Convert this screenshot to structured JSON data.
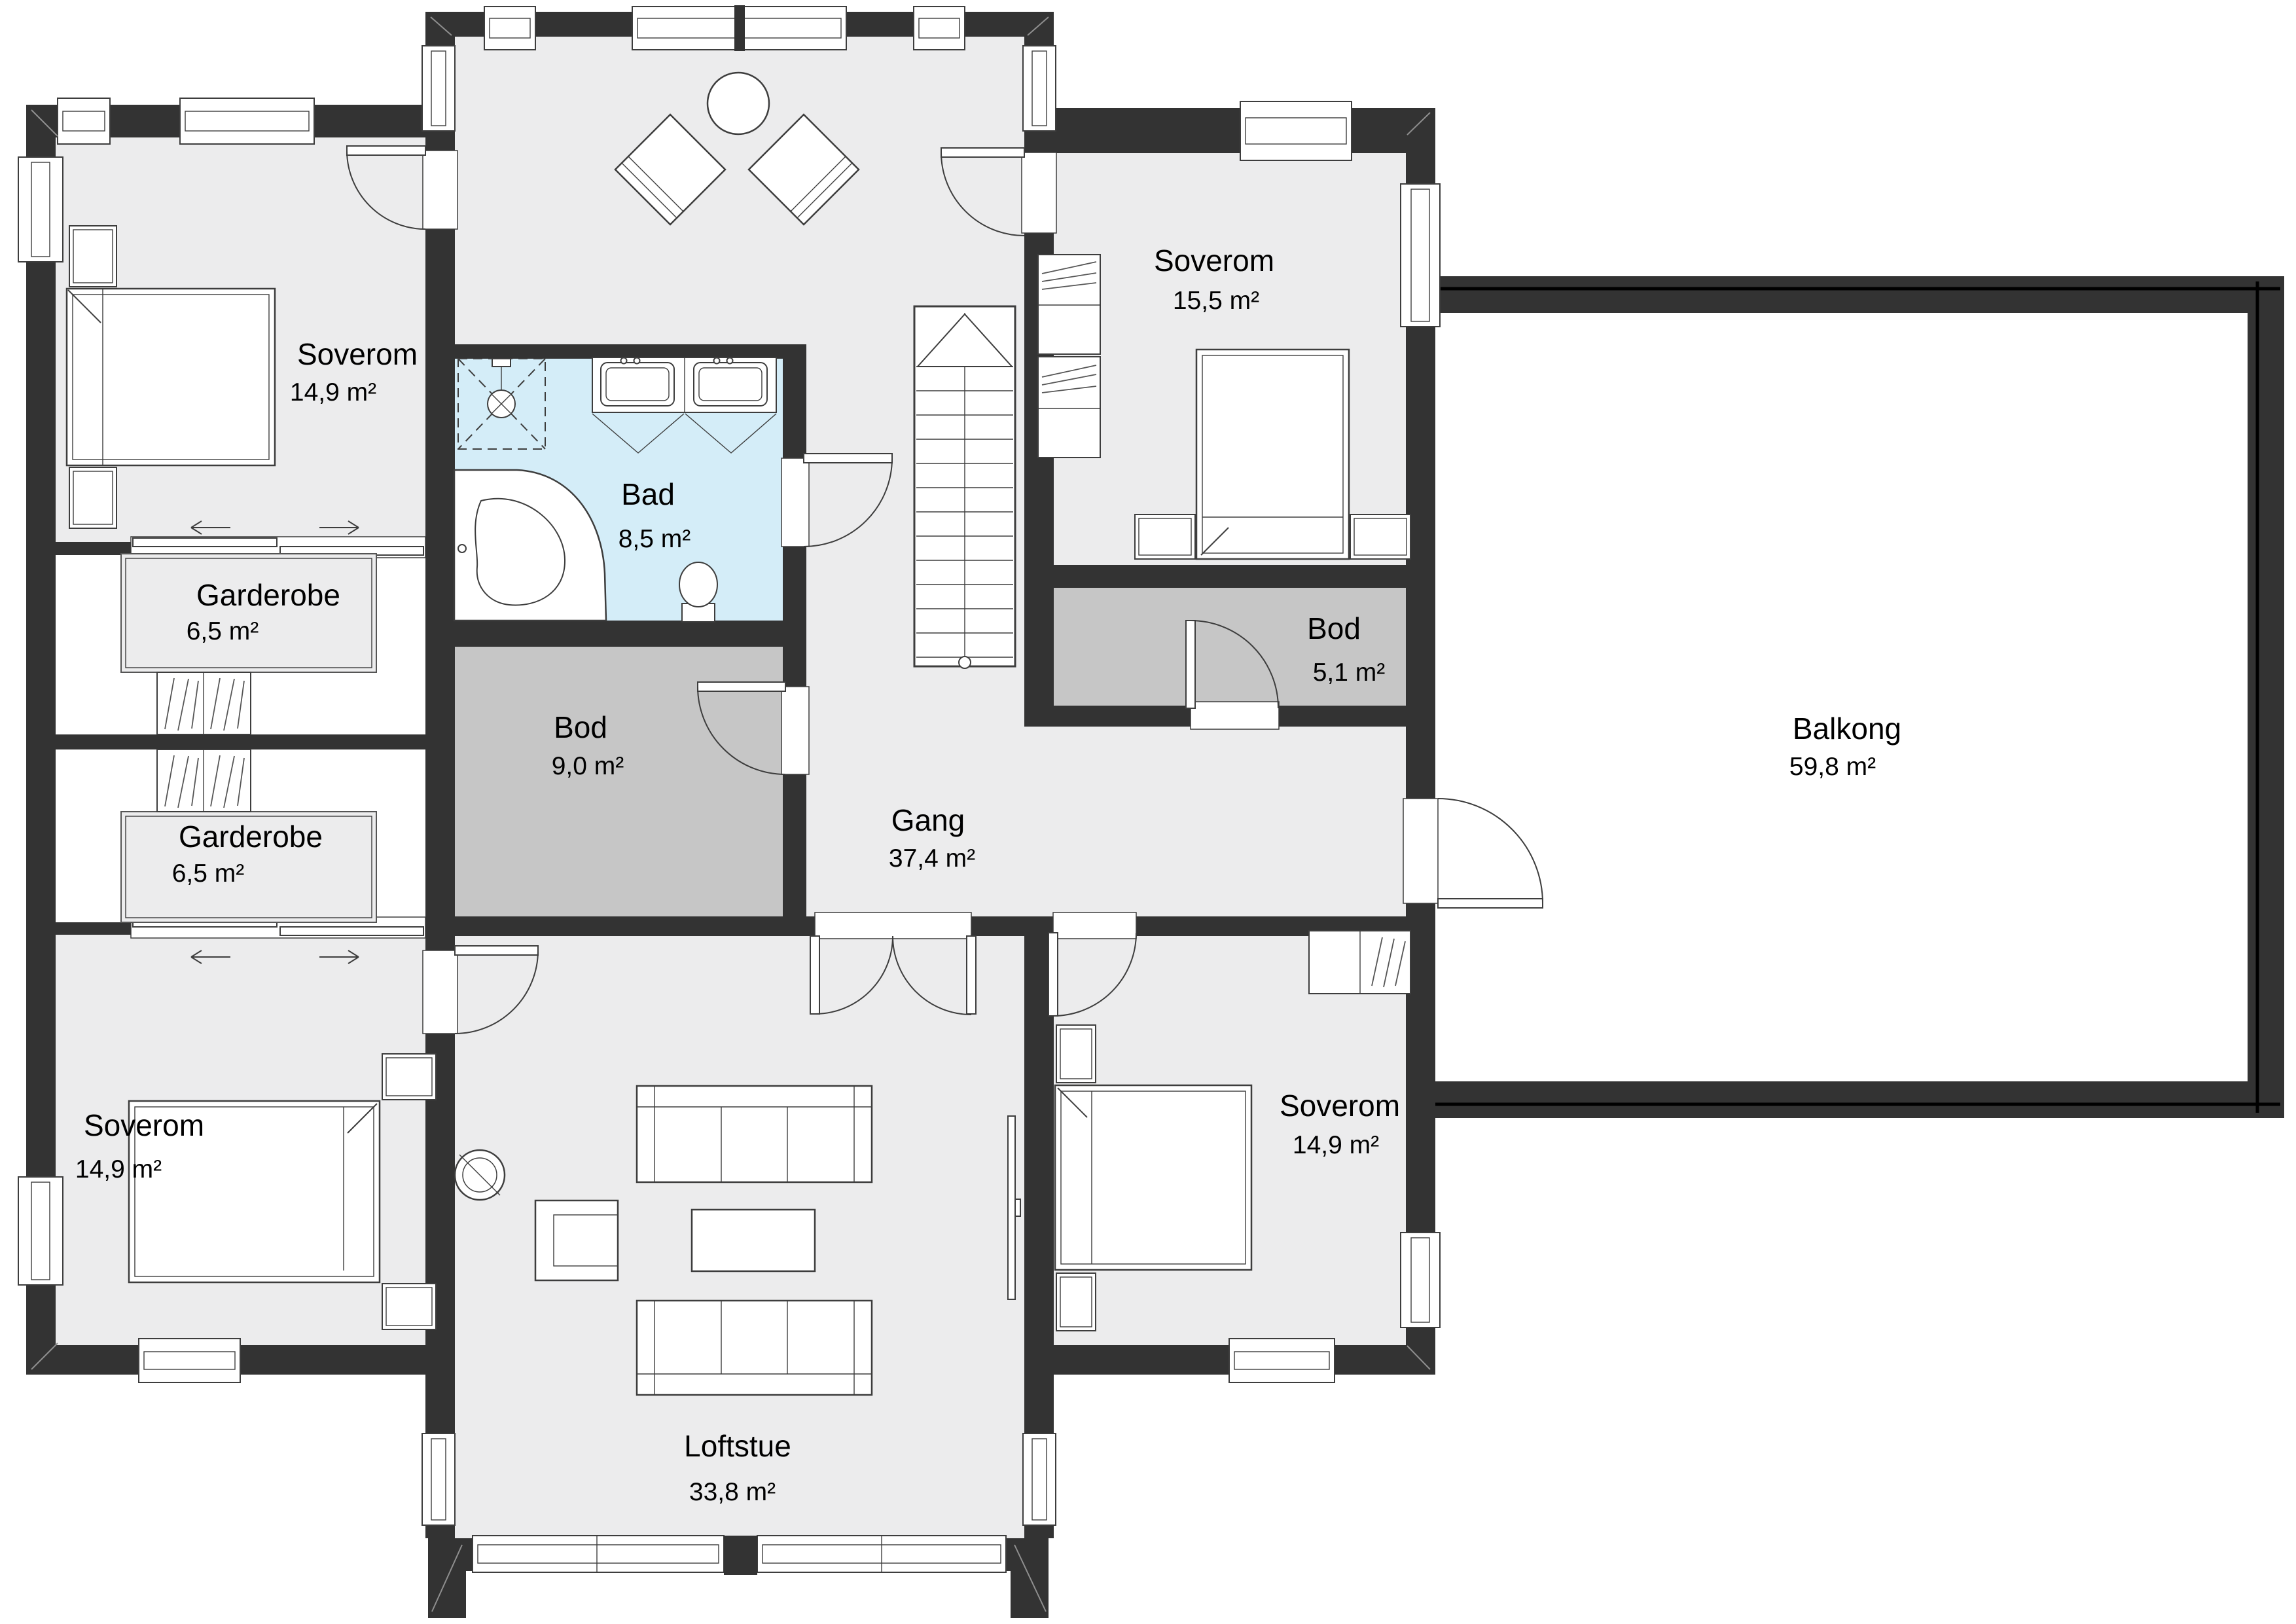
{
  "plan": {
    "colors": {
      "wall": "#333333",
      "floor": "#ececed",
      "storage_floor": "#c6c6c6",
      "bath_floor": "#d4edf8",
      "balcony_floor": "#ffffff",
      "line": "#3d3d3d",
      "text": "#000000"
    },
    "rooms": [
      {
        "id": "soverom-top-left",
        "name": "Soverom",
        "area": "14,9 m²"
      },
      {
        "id": "garderobe-upper",
        "name": "Garderobe",
        "area": "6,5 m²"
      },
      {
        "id": "garderobe-lower",
        "name": "Garderobe",
        "area": "6,5 m²"
      },
      {
        "id": "soverom-bottom-left",
        "name": "Soverom",
        "area": "14,9 m²"
      },
      {
        "id": "bad",
        "name": "Bad",
        "area": "8,5 m²"
      },
      {
        "id": "bod-center",
        "name": "Bod",
        "area": "9,0 m²"
      },
      {
        "id": "gang",
        "name": "Gang",
        "area": "37,4 m²"
      },
      {
        "id": "soverom-top-right",
        "name": "Soverom",
        "area": "15,5 m²"
      },
      {
        "id": "bod-right",
        "name": "Bod",
        "area": "5,1 m²"
      },
      {
        "id": "soverom-bottom-right",
        "name": "Soverom",
        "area": "14,9 m²"
      },
      {
        "id": "loftstue",
        "name": "Loftstue",
        "area": "33,8 m²"
      },
      {
        "id": "balkong",
        "name": "Balkong",
        "area": "59,8 m²"
      }
    ]
  }
}
